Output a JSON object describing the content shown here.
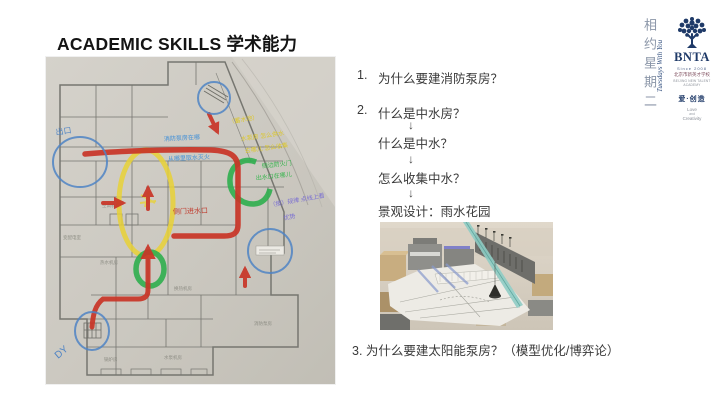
{
  "slide": {
    "title": "ACADEMIC SKILLS 学术能力"
  },
  "questions": {
    "item1_num": "1.",
    "item1_text": "为什么要建消防泵房？",
    "item2_num": "2.",
    "item2_text": "什么是中水房？",
    "arrow_glyph": "↓",
    "flow_step1": "什么是中水？",
    "flow_step2": "怎么收集中水？",
    "flow_step3": "景观设计：雨水花园",
    "item3_text": "3. 为什么要建太阳能泵房？（模型优化/博弈论）"
  },
  "floorplan": {
    "exit_label": "出口",
    "dy_label": "DY",
    "blue_note_line1": "消防泵房在哪",
    "blue_note_line2": "从哪里取水灭火",
    "red_note": "侧门进水口",
    "yellow_note_line1": "（蓄水池）",
    "yellow_note_line2": "水泵房 怎么供水",
    "yellow_note_line3": "去哪儿 怎么收集",
    "green_note_line1": "侧边防火门",
    "green_note_line2": "出水口在哪儿",
    "purple_note_line1": "（按）规律 点线上看",
    "purple_note_line2": "优势",
    "room_labels": {
      "r1": "空调机房",
      "r2": "热水机房",
      "r3": "变配电室",
      "r4": "换热机房",
      "r5": "水泵机房",
      "r6": "锅炉房",
      "r7": "消防泵房"
    }
  },
  "sidebar": {
    "vertical_title": "相约星期二",
    "rotated_subtitle": "Tuesdays With You",
    "logo_text": "BNTA",
    "since_text": "Since 2008",
    "school_cn": "北京市新英才学校",
    "school_en": "BEIJING NEW TALENT ACADEMY",
    "slogan_cn": "爱·创造",
    "slogan_en1": "Love",
    "slogan_en2": "and",
    "slogan_en3": "Creativity"
  },
  "colors": {
    "route_red": "#c93527",
    "highlight_yellow": "#e8d136",
    "highlight_green": "#2fae4e",
    "annotation_blue": "#4f84c4",
    "brand_navy": "#1f3a68"
  }
}
